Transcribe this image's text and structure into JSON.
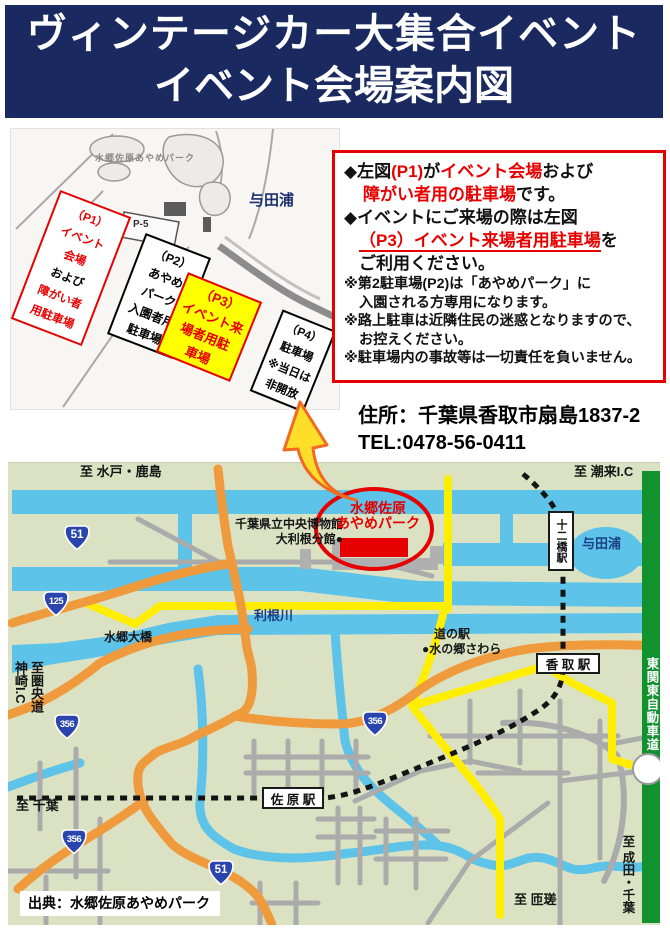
{
  "header": {
    "line1": "ヴィンテージカー大集合イベント",
    "line2": "イベント会場案内図"
  },
  "park_map": {
    "name": "水郷佐原あやめパーク",
    "p5": "P-5",
    "yodaura": "与田浦",
    "p1": [
      "（P1）",
      "イベント",
      "会場",
      "および",
      "障がい者",
      "用駐車場"
    ],
    "p2": [
      "（P2）",
      "あやめ",
      "パーク",
      "入園者用",
      "駐車場"
    ],
    "p3": [
      "（P3）",
      "イベント来",
      "場者用駐",
      "車場"
    ],
    "p4": [
      "（P4）",
      "駐車場",
      "※当日は",
      "非開放"
    ]
  },
  "info_box": {
    "b1_pre": "◆左図",
    "b1_red1": "(P1)",
    "b1_mid": "が",
    "b1_red2": "イベント会場",
    "b1_tail": "および",
    "b1_l2_red": "障がい者用の駐車場",
    "b1_l2_tail": "です。",
    "b2_l1": "◆イベントにご来場の際は左図",
    "b2_red": "（P3）イベント来場者用駐車場",
    "b2_tail": "を",
    "b2_l3": "ご利用ください。",
    "n1a": "※第2駐車場(P2)は「あやめパーク」に",
    "n1b": "入園される方専用になります。",
    "n2a": "※路上駐車は近隣住民の迷惑となりますので、",
    "n2b": "お控えください。",
    "n3": "※駐車場内の事故等は一切責任を負いません。"
  },
  "address": {
    "line1": "住所：千葉県香取市扇島1837-2",
    "line2": "TEL:0478-56-0411"
  },
  "road_map": {
    "labels": {
      "to_mito": "至 水戸・鹿島",
      "to_itako": "至 潮来I.C",
      "museum1": "千葉県立中央博物館",
      "museum2": "大利根分館●",
      "park1": "水郷佐原",
      "park2": "あやめパーク",
      "tonegawa": "利根川",
      "ohashi": "水郷大橋",
      "yodaura": "与田浦",
      "michinoeki1": "道の駅",
      "michinoeki2": "●水の郷さわら",
      "to_chiba": "至 千葉",
      "to_sosa": "至 匝瑳",
      "kanzaki1": "至圏央道",
      "kanzaki2": "神崎I.C",
      "expressway": "東関東自動車道",
      "to_narita": "至 成田・千葉"
    },
    "stations": {
      "juniko": "十二橋駅",
      "katori": "香 取 駅",
      "sawara": "佐 原 駅"
    },
    "shields": [
      "51",
      "125",
      "356",
      "356",
      "356",
      "51"
    ],
    "source": "出典：水郷佐原あやめパーク"
  },
  "colors": {
    "navy": "#1a2a60",
    "red": "#e60000",
    "map_bg": "#dbe2c3",
    "water": "#5ec3e8",
    "orange_road": "#ef9a3c",
    "yellow_road": "#ffee00",
    "green_road": "#12912f",
    "highlight_yellow": "#ffff00"
  }
}
